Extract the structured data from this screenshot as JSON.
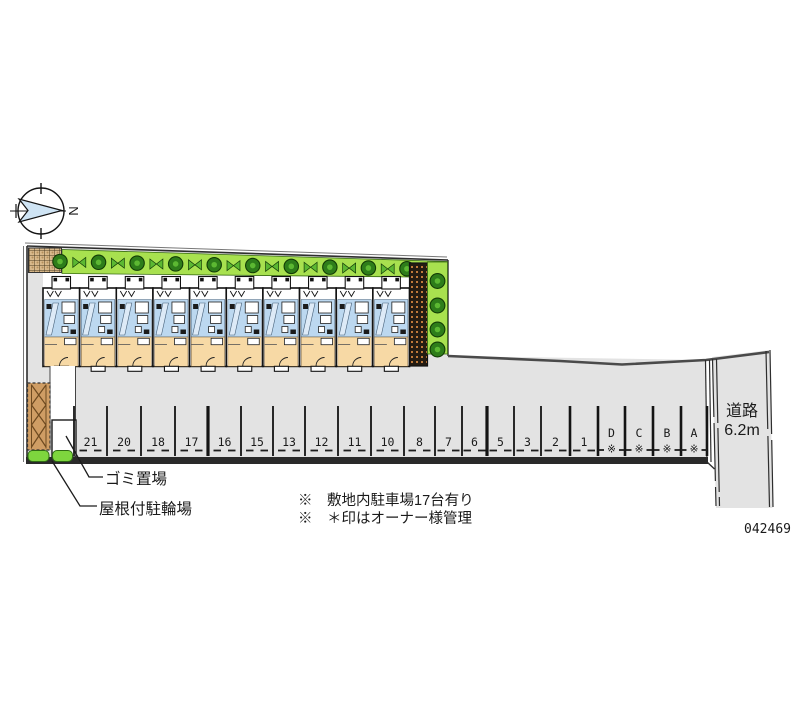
{
  "meta": {
    "plan_id": "042469"
  },
  "compass": {
    "label": "N"
  },
  "road": {
    "name": "道路",
    "width": "6.2m"
  },
  "labels": {
    "garbage": "ゴミ置場",
    "bicycle": "屋根付駐輪場"
  },
  "notes": {
    "line1": "※　敷地内駐車場17台有り",
    "line2": "※　＊印はオーナー様管理"
  },
  "parking": {
    "managed_mark": "※",
    "spaces": [
      {
        "label": "21",
        "managed": false
      },
      {
        "label": "20",
        "managed": false
      },
      {
        "label": "18",
        "managed": false
      },
      {
        "label": "17",
        "managed": false
      },
      {
        "label": "16",
        "managed": false
      },
      {
        "label": "15",
        "managed": false
      },
      {
        "label": "13",
        "managed": false
      },
      {
        "label": "12",
        "managed": false
      },
      {
        "label": "11",
        "managed": false
      },
      {
        "label": "10",
        "managed": false
      },
      {
        "label": "8",
        "managed": false
      },
      {
        "label": "7",
        "managed": false
      },
      {
        "label": "6",
        "managed": false
      },
      {
        "label": "5",
        "managed": false
      },
      {
        "label": "3",
        "managed": false
      },
      {
        "label": "2",
        "managed": false
      },
      {
        "label": "1",
        "managed": false
      },
      {
        "label": "D",
        "managed": true
      },
      {
        "label": "C",
        "managed": true
      },
      {
        "label": "B",
        "managed": true
      },
      {
        "label": "A",
        "managed": true
      }
    ]
  },
  "building": {
    "unit_count": 10
  },
  "landscape": {
    "top_tree_count": 10,
    "top_shrub_count": 9,
    "side_tree_count": 4
  },
  "colors": {
    "site_fill": "#e3e3e3",
    "road_fill": "#e3e3e3",
    "green_strip": "#a8e14f",
    "green_blob": "#7ed63e",
    "tree_dark": "#2e7d1a",
    "tree_mid": "#5cb832",
    "unit_blue": "#bcd8f0",
    "unit_blue_light": "#ddeaf7",
    "unit_orange": "#f7d9a5",
    "shed_tan": "#cf9d64",
    "hatch_tan": "#d8b98c",
    "wall": "#121212",
    "boundary": "#333333",
    "text": "#1a1a1a"
  }
}
